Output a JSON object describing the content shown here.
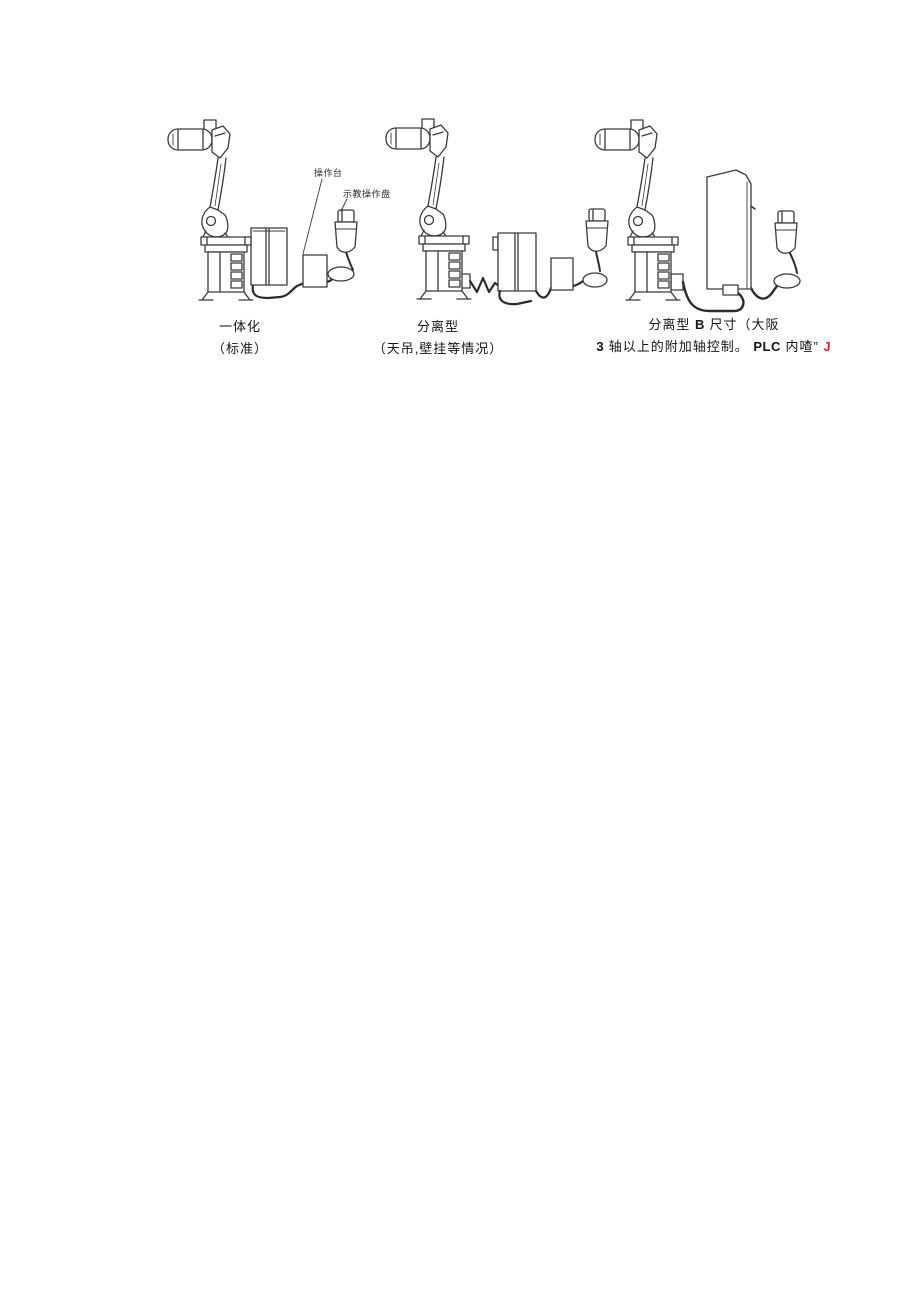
{
  "page": {
    "background": "#ffffff",
    "type": "scanned-document-figure"
  },
  "colors": {
    "line_art": "#3a3a3a",
    "cable": "#2c2c2c",
    "caption_text": "#151515",
    "red_mark": "#d22a2a"
  },
  "annotations": {
    "console_label": "操作台",
    "pendant_label": "示教操作盘"
  },
  "figures": [
    {
      "id": "integrated",
      "caption_line1": "一体化",
      "caption_line2": "（标准）"
    },
    {
      "id": "separated",
      "caption_line1": "分离型",
      "caption_line2": "（天吊,壁挂等情况）"
    },
    {
      "id": "separated-b",
      "caption_line1_pre": "分离型 ",
      "caption_line1_bold": "B",
      "caption_line1_post": " 尺寸（大阪",
      "caption_line2_bold1": "3",
      "caption_line2_text1": " 轴以上的附加轴控制。 ",
      "caption_line2_bold2": "PLC",
      "caption_line2_text2": " 内喳” ",
      "caption_line2_red": "J"
    }
  ]
}
